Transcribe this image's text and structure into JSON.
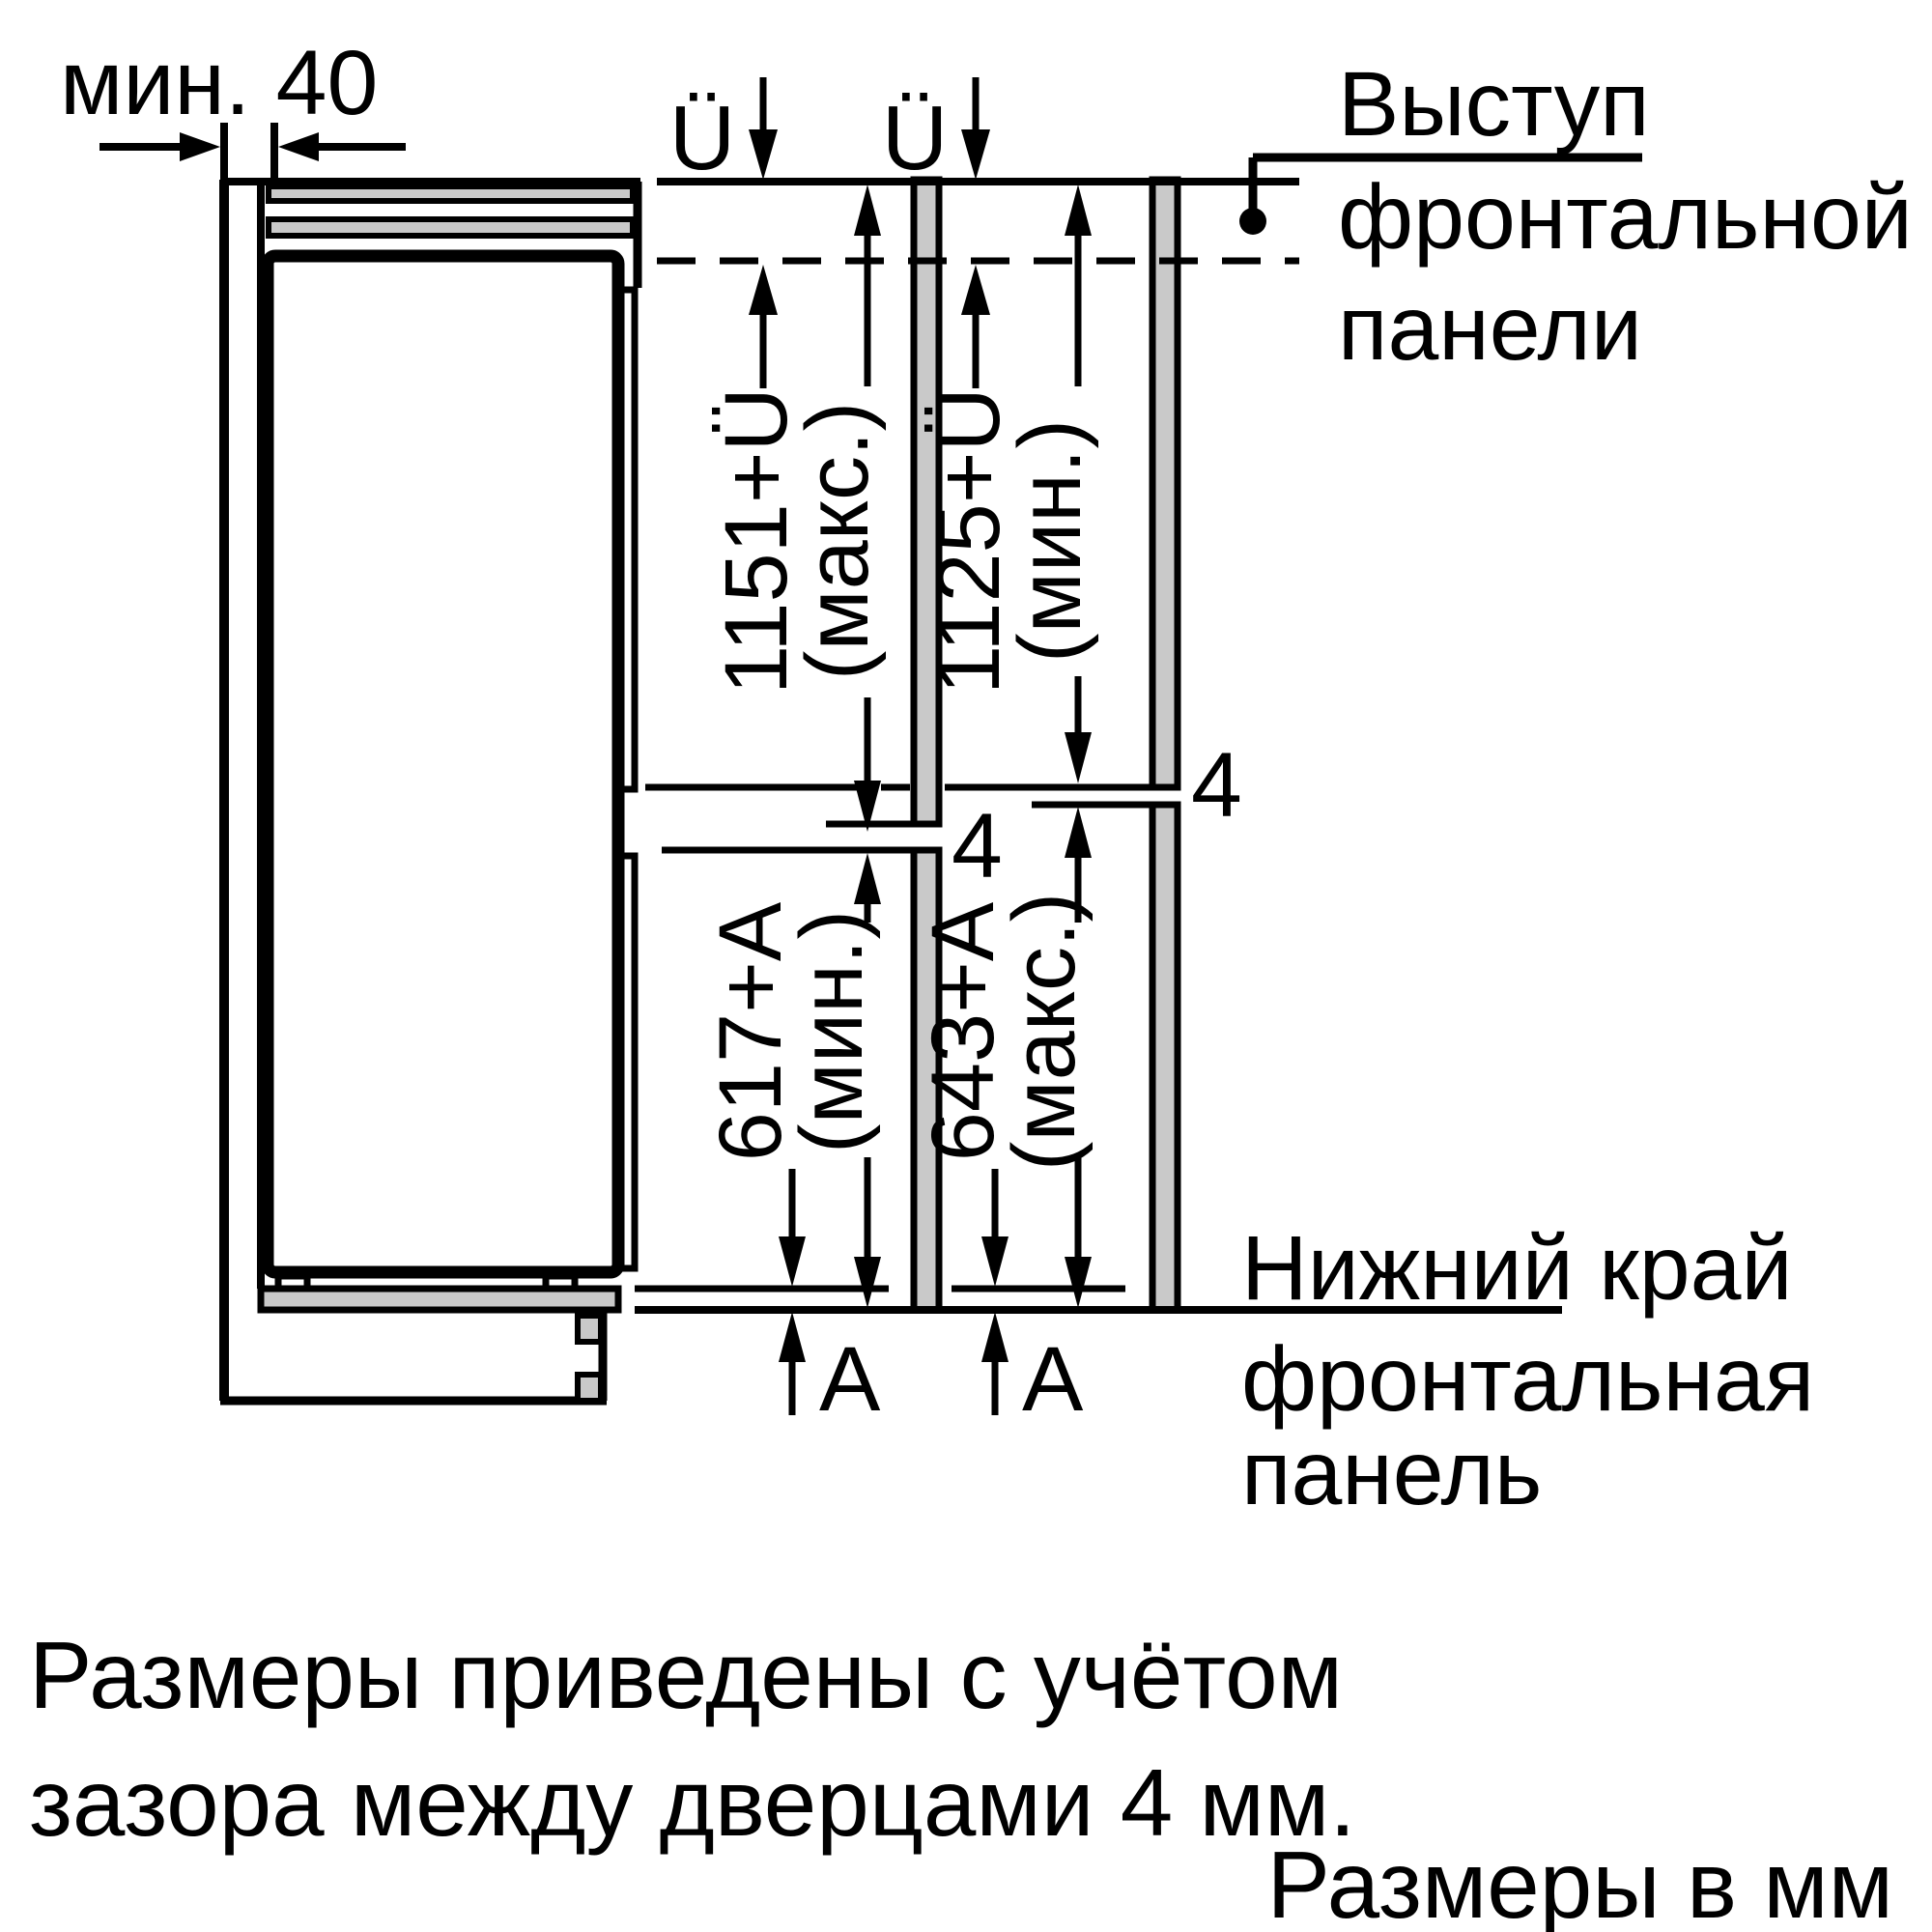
{
  "colors": {
    "line": "#000000",
    "panel_gray": "#c9c9c9",
    "background": "#ffffff"
  },
  "top_left_dimension": {
    "label": "мин. 40"
  },
  "overhang_top": {
    "left_label": "Ü",
    "right_label": "Ü"
  },
  "callout_top_right": {
    "line1": "Выступ",
    "line2": "фронтальной",
    "line3": "панели"
  },
  "dimensions": {
    "upper_left": {
      "value": "1151+Ü",
      "qualifier": "(макс.)"
    },
    "upper_right": {
      "value": "1125+Ü",
      "qualifier": "(мин.)"
    },
    "lower_left": {
      "value": "617+A",
      "qualifier": "(мин.)"
    },
    "lower_right": {
      "value": "643+A",
      "qualifier": "(макс.)"
    }
  },
  "door_gaps": {
    "left_gap": "4",
    "right_gap": "4"
  },
  "bottom_protrusion": {
    "left_label": "A",
    "right_label": "A"
  },
  "callout_bottom_right": {
    "line1": "Нижний край",
    "line2": "фронтальная",
    "line3": "панель"
  },
  "footnote": {
    "line1": "Размеры приведены с учётом",
    "line2": "зазора между дверцами 4 мм."
  },
  "units_note": "Размеры в мм"
}
